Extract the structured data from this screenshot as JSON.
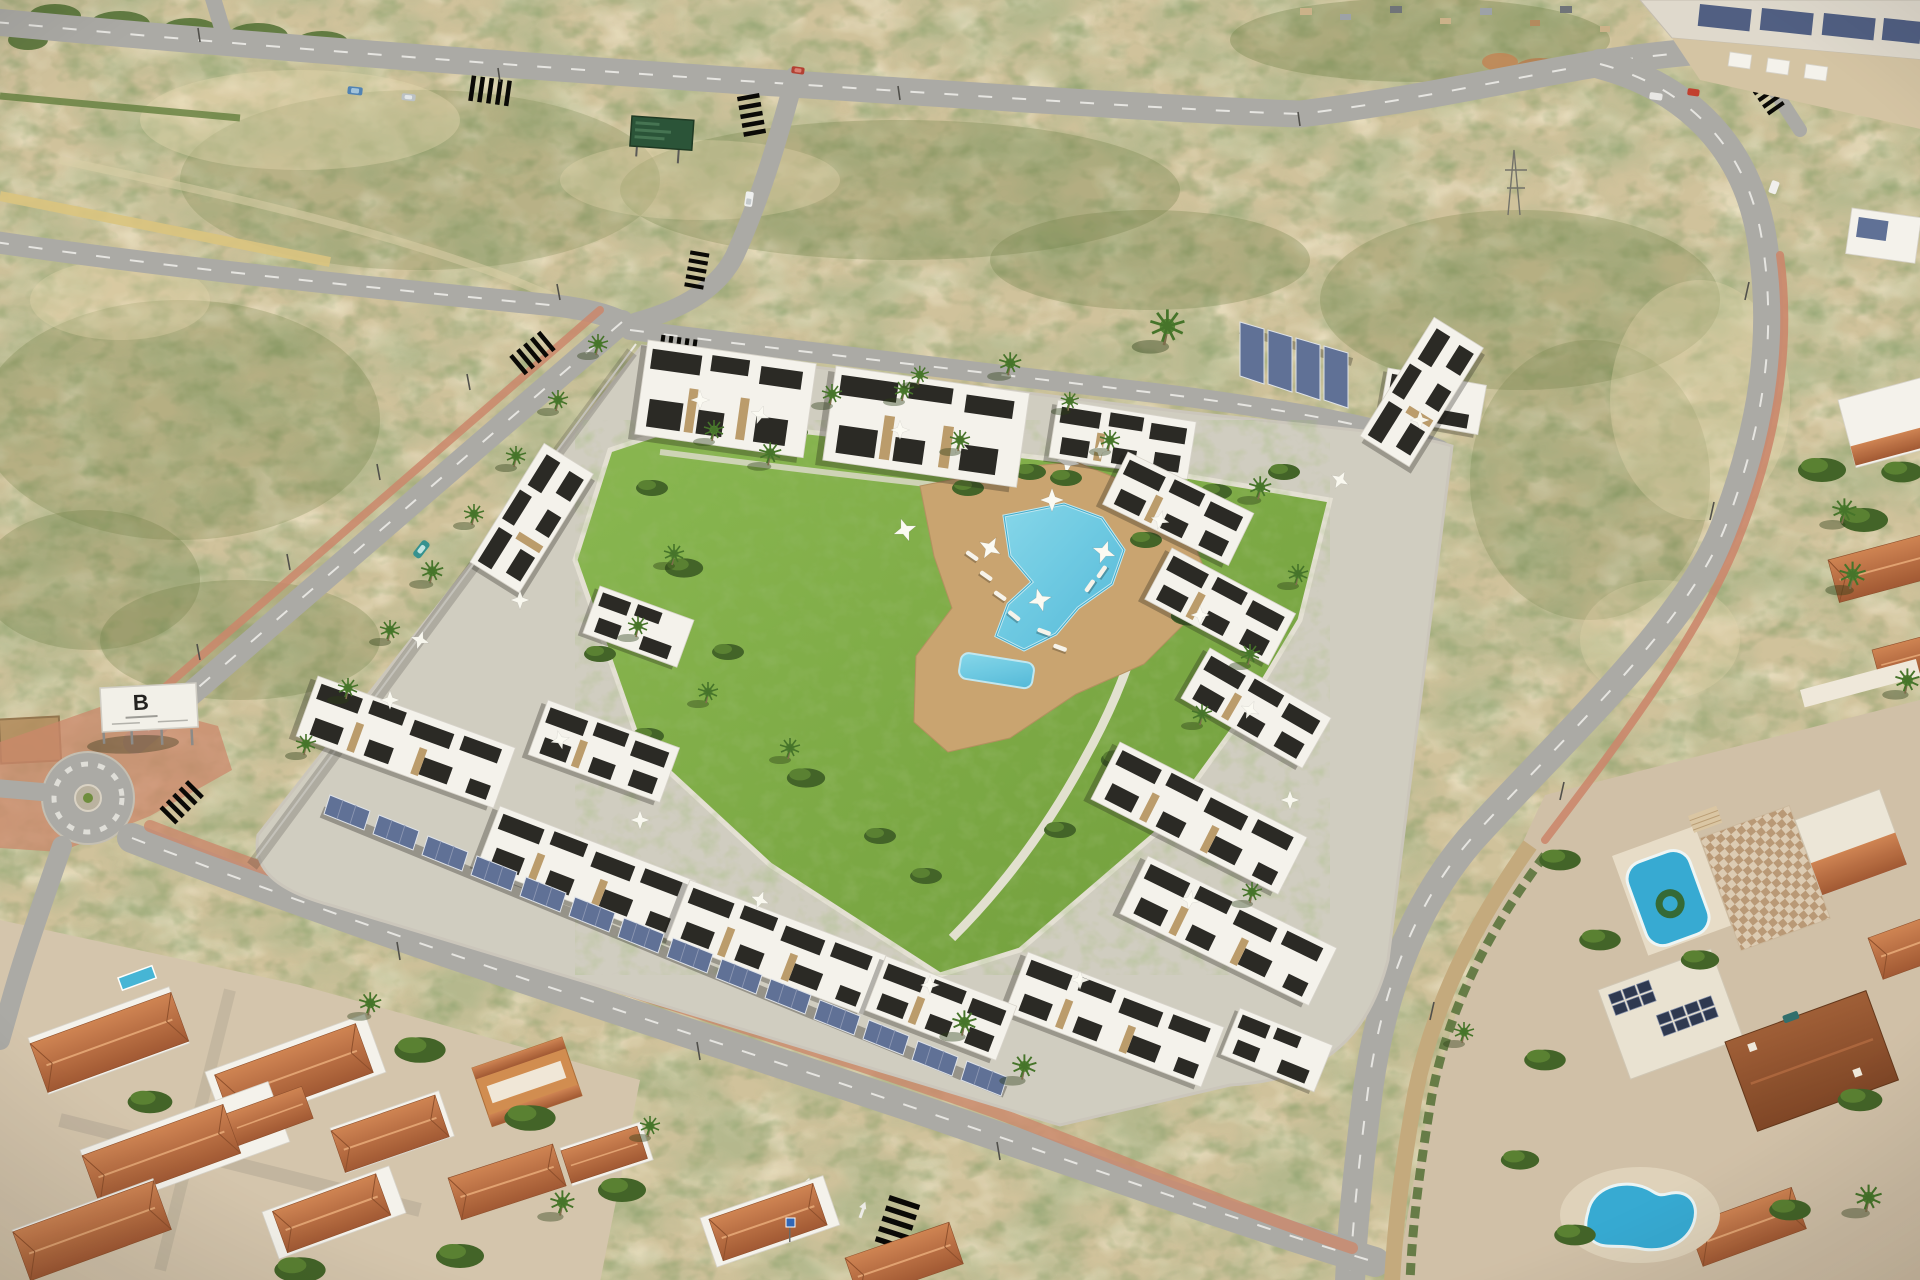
{
  "billboard": {
    "logo_letter": "B"
  },
  "colors": {
    "scrub_base": "#cfc19c",
    "scrub_olive": "#6b7a42",
    "scrub_dark": "#4c5c30",
    "road_gray": "#a8a8a6",
    "road_light": "#b3b3b1",
    "lane_white": "#f0f0ee",
    "sidewalk_red": "#c9846a",
    "yellow_wall": "#d9c37e",
    "lawn_green": "#7aa843",
    "pool_blue": "#5cc6e4",
    "deck_tan": "#c7a26f",
    "building_white": "#f4f3ef",
    "building_black": "#232321",
    "stone_accent": "#b9996a",
    "solar_blue": "#5a6d96",
    "terracotta": "#b5633c",
    "roof_brown": "#8a4a28",
    "hood_pool_blue": "#2fa8d5",
    "wall_stone": "#c2a87c",
    "sign_green": "#234f35",
    "billboard_white": "#f2f1ec"
  }
}
